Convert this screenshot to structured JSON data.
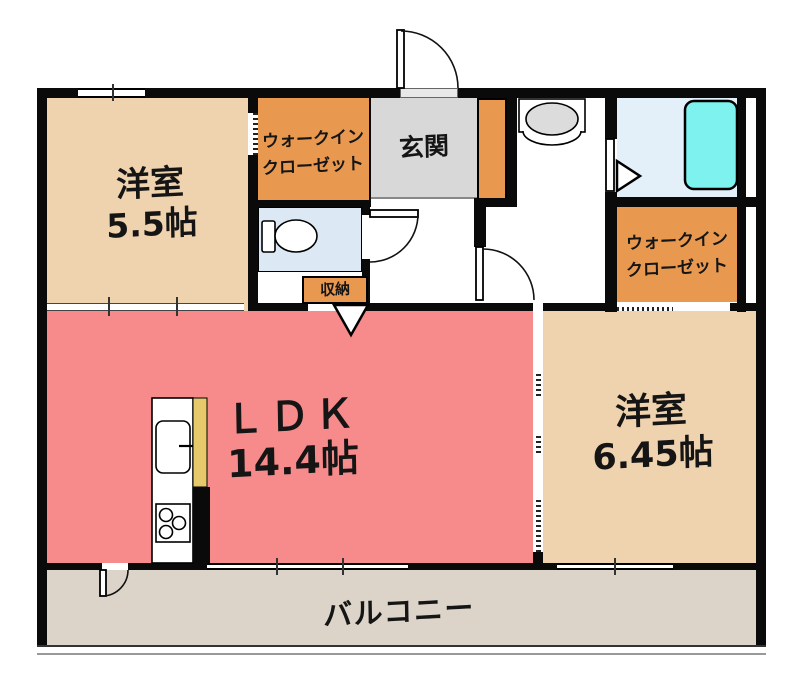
{
  "rooms": {
    "bedroom_top": {
      "label": "洋室",
      "size": "5.5帖"
    },
    "walkin_closet_top": {
      "line1": "ウォークイン",
      "line2": "クローゼット"
    },
    "genkan": {
      "label": "玄関"
    },
    "storage": {
      "label": "収納"
    },
    "ldk": {
      "label": "ＬＤＫ",
      "size": "14.4帖"
    },
    "bedroom_right": {
      "label": "洋室",
      "size": "6.45帖"
    },
    "walkin_closet_right": {
      "line1": "ウォークイン",
      "line2": "クローゼット"
    },
    "balcony": {
      "label": "バルコニー"
    }
  },
  "colors": {
    "wall": "#0a0a0a",
    "beige": "#efd2ae",
    "orange": "#e8994f",
    "pink": "#f78b8b",
    "genkan": "#d8d8d8",
    "wet": "#dce9f5",
    "bath": "#e3eff9",
    "tub": "#7ef2ee",
    "balcony": "#dcd4c8",
    "counter": "#e6c96b",
    "fixture": "#dcdcdc"
  }
}
